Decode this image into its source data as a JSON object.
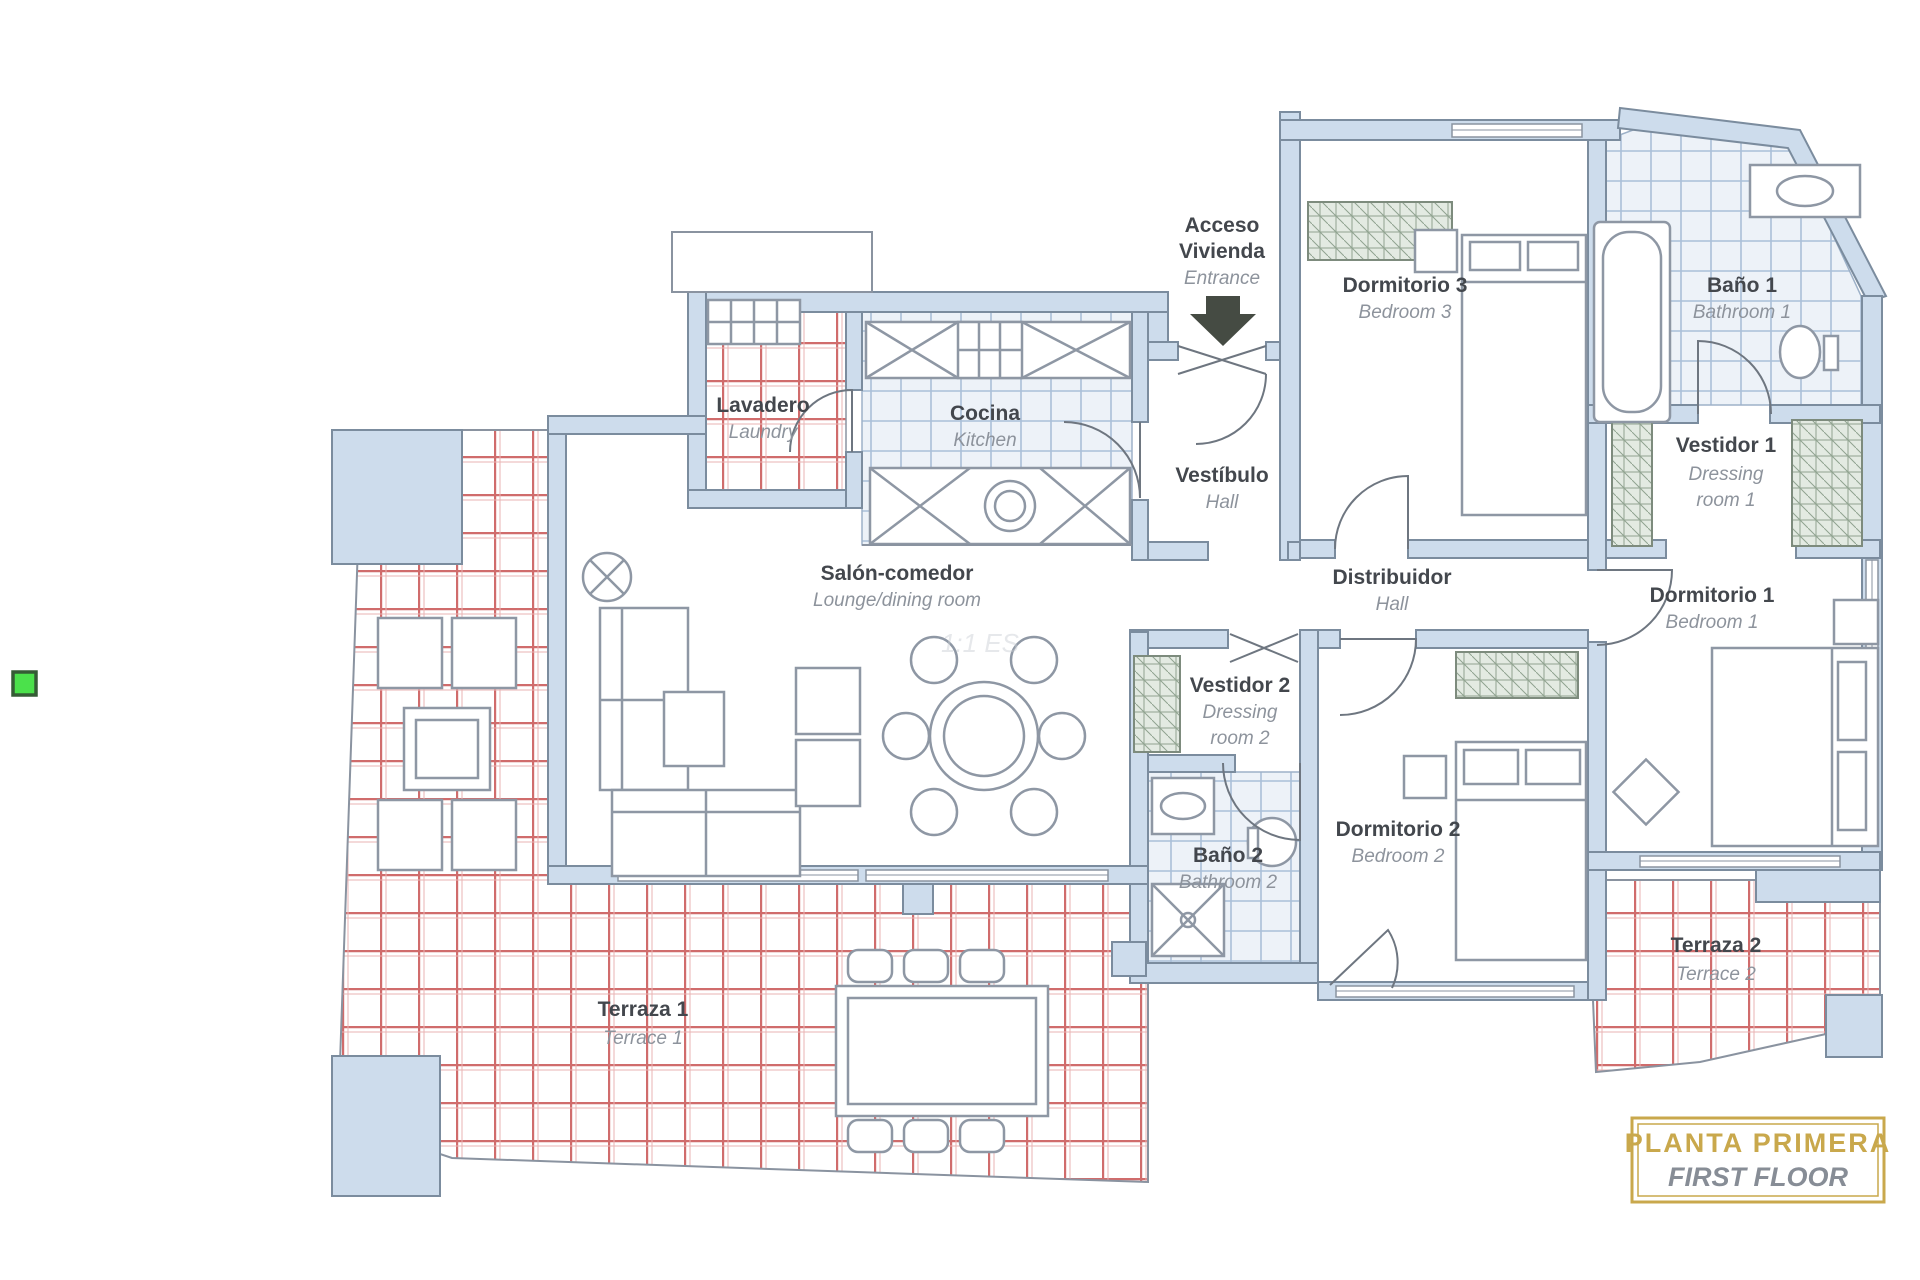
{
  "rooms": {
    "acceso": {
      "line1": "Acceso",
      "line2": "Vivienda",
      "line3": "Entrance"
    },
    "dormitorio3": {
      "es": "Dormitorio 3",
      "en": "Bedroom 3"
    },
    "bano1": {
      "es": "Baño 1",
      "en": "Bathroom 1"
    },
    "vestidor1": {
      "es": "Vestidor 1",
      "en1": "Dressing",
      "en2": "room 1"
    },
    "dormitorio1": {
      "es": "Dormitorio 1",
      "en": "Bedroom 1"
    },
    "lavadero": {
      "es": "Lavadero",
      "en": "Laundry"
    },
    "cocina": {
      "es": "Cocina",
      "en": "Kitchen"
    },
    "vestibulo": {
      "es": "Vestíbulo",
      "en": "Hall"
    },
    "salon": {
      "es": "Salón-comedor",
      "en": "Lounge/dining room"
    },
    "distribuidor": {
      "es": "Distribuidor",
      "en": "Hall"
    },
    "vestidor2": {
      "es": "Vestidor 2",
      "en1": "Dressing",
      "en2": "room 2"
    },
    "bano2": {
      "es": "Baño 2",
      "en": "Bathroom 2"
    },
    "dormitorio2": {
      "es": "Dormitorio 2",
      "en": "Bedroom 2"
    },
    "terraza1": {
      "es": "Terraza 1",
      "en": "Terrace 1"
    },
    "terraza2": {
      "es": "Terraza 2",
      "en": "Terrace 2"
    }
  },
  "title_box": {
    "line1": "PLANTA PRIMERA",
    "line2": "FIRST FLOOR"
  },
  "watermark": "1:1 ES",
  "colors": {
    "wall_fill": "#cddcec",
    "wall_edge": "#7b8c9e",
    "tile_red": "#d06c6c",
    "tile_blue": "#aabfd8",
    "furniture": "#8e97a4",
    "label_es": "#43474d",
    "label_en": "#8d939c",
    "title_gold": "#c9a84c",
    "marker_green": "#4be14b",
    "marker_border": "#355c35"
  }
}
